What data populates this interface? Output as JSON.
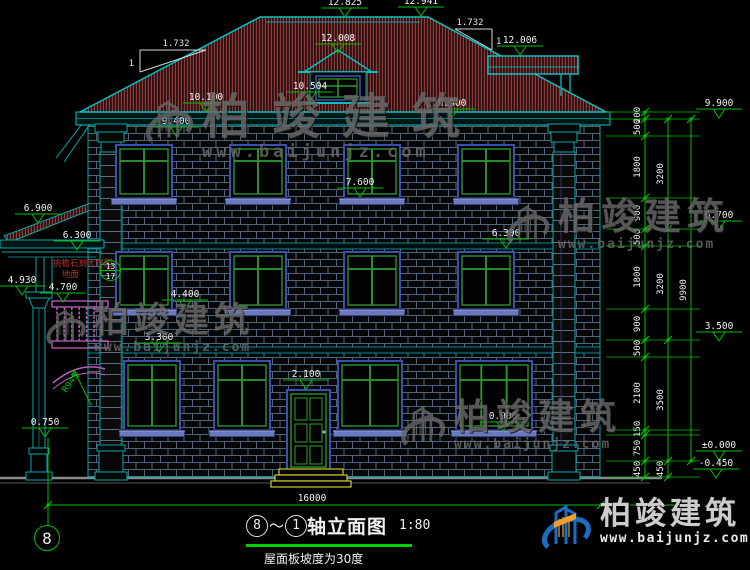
{
  "palette": {
    "green": "#00BE00",
    "bright_green": "#00D000",
    "teal": "#00A8A8",
    "bright_teal": "#00C4C4",
    "white": "#F0F0F0",
    "navy": "#3A50B0",
    "window_green": "#2E9E2E",
    "sill_blue": "#6A78C0",
    "magenta": "#C05CC0",
    "yellow": "#C8C832",
    "roof_red": "#8E3C3C",
    "mortar": "#51637A",
    "gray_line": "#8A8A8A",
    "red_text": "#C03030",
    "watermark_gray": "#6A6A6A",
    "logo_blue": "#1A6FC4",
    "logo_orange": "#F0A030"
  },
  "title_block": {
    "axis_start": "8",
    "separator": "～",
    "axis_end": "1",
    "name": "轴立面图",
    "scale": "1:80",
    "note": "屋面板坡度为30度"
  },
  "axis_bubble": {
    "label": "8"
  },
  "overall_dimension": {
    "value": "16000"
  },
  "brand": {
    "name": "柏竣建筑",
    "url": "www.baijunjz.com"
  },
  "detail_callout": {
    "line1": "挑檐石刻大样图",
    "line2": "地面",
    "sheet": "13",
    "page": "17"
  },
  "arch_radius": "R943",
  "slope_symbols": [
    {
      "run": "1.732",
      "rise": "1",
      "side": "left"
    },
    {
      "run": "1.732",
      "rise": "1",
      "side": "right"
    }
  ],
  "elevation_markers": [
    {
      "value": "12.825",
      "x": 345,
      "y": 17
    },
    {
      "value": "12.941",
      "x": 421,
      "y": 16
    },
    {
      "value": "12.008",
      "x": 338,
      "y": 53
    },
    {
      "value": "12.006",
      "x": 520,
      "y": 55
    },
    {
      "value": "10.504",
      "x": 310,
      "y": 101
    },
    {
      "value": "10.100",
      "x": 206,
      "y": 112
    },
    {
      "value": "9.900",
      "x": 452,
      "y": 118
    },
    {
      "value": "9.400",
      "x": 176,
      "y": 136
    },
    {
      "value": "7.600",
      "x": 360,
      "y": 197
    },
    {
      "value": "6.900",
      "x": 38,
      "y": 223
    },
    {
      "value": "6.300",
      "x": 77,
      "y": 250
    },
    {
      "value": "6.300",
      "x": 506,
      "y": 248
    },
    {
      "value": "4.930",
      "x": 22,
      "y": 295
    },
    {
      "value": "4.700",
      "x": 63,
      "y": 302
    },
    {
      "value": "4.400",
      "x": 185,
      "y": 309
    },
    {
      "value": "3.300",
      "x": 159,
      "y": 352
    },
    {
      "value": "2.100",
      "x": 306,
      "y": 389
    },
    {
      "value": "0.900",
      "x": 503,
      "y": 431
    },
    {
      "value": "0.750",
      "x": 45,
      "y": 437
    },
    {
      "value": "9.900",
      "x": 719,
      "y": 118
    },
    {
      "value": "6.700",
      "x": 719,
      "y": 230
    },
    {
      "value": "3.500",
      "x": 719,
      "y": 341
    },
    {
      "value": "±0.000",
      "x": 719,
      "y": 460
    },
    {
      "value": "-0.450",
      "x": 716,
      "y": 478
    }
  ],
  "dimension_chains": [
    {
      "x": 645,
      "ticks": [
        112,
        119,
        136,
        198,
        229,
        246,
        309,
        340,
        357,
        430,
        435,
        461,
        477
      ],
      "labels": [
        {
          "v": "200",
          "y": 115
        },
        {
          "v": "500",
          "y": 127
        },
        {
          "v": "1800",
          "y": 167
        },
        {
          "v": "900",
          "y": 213
        },
        {
          "v": "500",
          "y": 237
        },
        {
          "v": "1800",
          "y": 277
        },
        {
          "v": "900",
          "y": 324
        },
        {
          "v": "500",
          "y": 348
        },
        {
          "v": "2100",
          "y": 393
        },
        {
          "v": "150",
          "y": 429
        },
        {
          "v": "750",
          "y": 448
        },
        {
          "v": "450",
          "y": 469
        }
      ]
    },
    {
      "x": 668,
      "ticks": [
        119,
        229,
        340,
        461,
        477
      ],
      "labels": [
        {
          "v": "3200",
          "y": 174
        },
        {
          "v": "3200",
          "y": 284
        },
        {
          "v": "3500",
          "y": 400
        },
        {
          "v": "450",
          "y": 469
        }
      ]
    },
    {
      "x": 691,
      "ticks": [
        119,
        461
      ],
      "labels": [
        {
          "v": "9900",
          "y": 290
        }
      ]
    }
  ],
  "extension_line_ys": [
    112,
    119,
    136,
    198,
    229,
    246,
    309,
    340,
    357,
    430,
    435,
    461,
    477
  ],
  "watermarks": [
    {
      "x": 138,
      "y": 92,
      "icon": 58,
      "name_size": 48,
      "name_ls": 22,
      "url_size": 17,
      "url_ls": 4
    },
    {
      "x": 500,
      "y": 198,
      "icon": 52,
      "name_size": 37,
      "name_ls": 6,
      "url_size": 13,
      "url_ls": 2
    },
    {
      "x": 40,
      "y": 303,
      "icon": 48,
      "name_size": 35,
      "name_ls": 5,
      "url_size": 13,
      "url_ls": 2
    },
    {
      "x": 394,
      "y": 399,
      "icon": 54,
      "name_size": 36,
      "name_ls": 6,
      "url_size": 13,
      "url_ls": 2
    }
  ]
}
